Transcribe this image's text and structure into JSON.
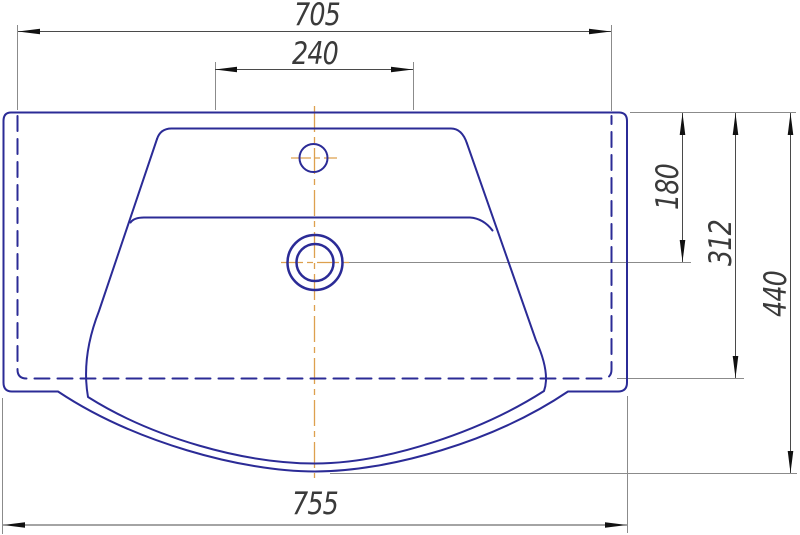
{
  "drawing": {
    "kind": "technical-drawing",
    "subject": "washbasin top view with dimensions"
  },
  "colors": {
    "outline": "#2b2b96",
    "centerline": "#dda04e",
    "dimension_line": "#4a4a4a",
    "extension_line": "#8b8b8b",
    "arrow": "#111111",
    "label_text": "#3a3a3a",
    "background": "#ffffff"
  },
  "dimensions": {
    "body_width": {
      "value": "705"
    },
    "faucet_zone_width": {
      "value": "240"
    },
    "drain_center_depth": {
      "value": "180"
    },
    "body_depth": {
      "value": "312"
    },
    "overall_depth": {
      "value": "440"
    },
    "overall_width": {
      "value": "755"
    }
  }
}
